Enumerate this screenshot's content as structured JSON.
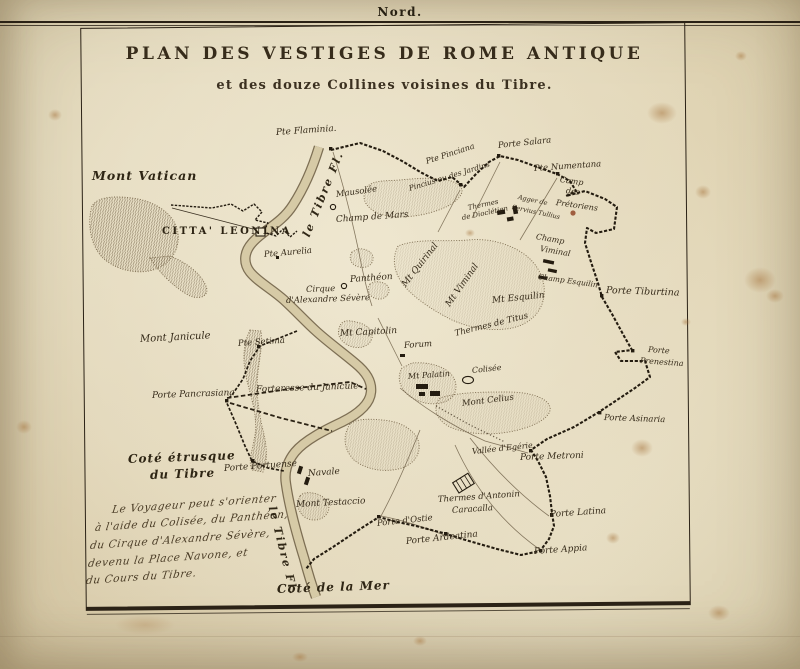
{
  "page": {
    "north_label": "Nord."
  },
  "map": {
    "title": "PLAN DES VESTIGES DE ROME ANTIQUE",
    "subtitle": "et des douze Collines voisines du Tibre.",
    "colors": {
      "ink": "#2b2214",
      "paper": "#e6ddc1",
      "river_fill": "#d6caa6",
      "river_edge": "#6a5a40",
      "stain": "#a97a45"
    },
    "labels": [
      {
        "t": "Pte Flaminia.",
        "x": 276,
        "y": 128,
        "r": -4,
        "s": 9
      },
      {
        "t": "Mont Vatican",
        "x": 92,
        "y": 168,
        "r": 0,
        "s": 12.5,
        "c": "bold"
      },
      {
        "t": "CITTA' LEONINA",
        "x": 162,
        "y": 226,
        "r": 0,
        "s": 10,
        "c": "caps"
      },
      {
        "t": "le Tibre Fl.",
        "x": 306,
        "y": 230,
        "r": -68,
        "s": 11,
        "c": "river"
      },
      {
        "t": "Mausolée",
        "x": 336,
        "y": 190,
        "r": -8,
        "s": 8.5
      },
      {
        "t": "Champ de Mars",
        "x": 336,
        "y": 215,
        "r": -4,
        "s": 9
      },
      {
        "t": "Pte Pinciana",
        "x": 426,
        "y": 157,
        "r": -18,
        "s": 8
      },
      {
        "t": "Pincius ou des Jardins",
        "x": 409,
        "y": 184,
        "r": -17,
        "s": 7.5
      },
      {
        "t": "Porte Salara",
        "x": 498,
        "y": 141,
        "r": -6,
        "s": 8.5
      },
      {
        "t": "Pte Numentana",
        "x": 534,
        "y": 164,
        "r": -4,
        "s": 8.5
      },
      {
        "t": "Camp",
        "x": 560,
        "y": 175,
        "r": 8,
        "s": 8
      },
      {
        "t": "des",
        "x": 566,
        "y": 186,
        "r": 8,
        "s": 8
      },
      {
        "t": "Prétoriens",
        "x": 556,
        "y": 198,
        "r": 8,
        "s": 8
      },
      {
        "t": "Agger de",
        "x": 518,
        "y": 193,
        "r": 12,
        "s": 6.5
      },
      {
        "t": "Servius Tullius",
        "x": 512,
        "y": 203,
        "r": 12,
        "s": 6.5
      },
      {
        "t": "Champ",
        "x": 536,
        "y": 232,
        "r": 10,
        "s": 8
      },
      {
        "t": "Viminal",
        "x": 540,
        "y": 244,
        "r": 10,
        "s": 8
      },
      {
        "t": "Champ Esquilin",
        "x": 538,
        "y": 272,
        "r": 8,
        "s": 7.5
      },
      {
        "t": "Porte Tiburtina",
        "x": 606,
        "y": 285,
        "r": 2,
        "s": 9.5
      },
      {
        "t": "Porte",
        "x": 648,
        "y": 345,
        "r": 4,
        "s": 8
      },
      {
        "t": "Prenestina",
        "x": 640,
        "y": 356,
        "r": 4,
        "s": 8
      },
      {
        "t": "Porte Asinaria",
        "x": 604,
        "y": 413,
        "r": 2,
        "s": 8.5
      },
      {
        "t": "Thermes",
        "x": 468,
        "y": 204,
        "r": -12,
        "s": 7
      },
      {
        "t": "de Dioclétien",
        "x": 462,
        "y": 214,
        "r": -12,
        "s": 7
      },
      {
        "t": "Mt Quirinal",
        "x": 404,
        "y": 281,
        "r": -52,
        "s": 9
      },
      {
        "t": "Mt Viminal",
        "x": 448,
        "y": 301,
        "r": -55,
        "s": 9
      },
      {
        "t": "Mt Esquilin",
        "x": 492,
        "y": 296,
        "r": -6,
        "s": 9
      },
      {
        "t": "Thermes de Titus",
        "x": 455,
        "y": 329,
        "r": -14,
        "s": 8.5
      },
      {
        "t": "Colisée",
        "x": 472,
        "y": 366,
        "r": -6,
        "s": 8
      },
      {
        "t": "Forum",
        "x": 404,
        "y": 341,
        "r": -4,
        "s": 8.5
      },
      {
        "t": "Mt Capitolin",
        "x": 340,
        "y": 329,
        "r": -3,
        "s": 9
      },
      {
        "t": "Panthéon",
        "x": 350,
        "y": 275,
        "r": -4,
        "s": 9
      },
      {
        "t": "Pte Aurelia",
        "x": 264,
        "y": 250,
        "r": -5,
        "s": 8.5
      },
      {
        "t": "Cirque",
        "x": 306,
        "y": 285,
        "r": -2,
        "s": 8.5
      },
      {
        "t": "d'Alexandre Sévère",
        "x": 286,
        "y": 296,
        "r": -2,
        "s": 8.5
      },
      {
        "t": "Mt Palatin",
        "x": 408,
        "y": 372,
        "r": -4,
        "s": 8
      },
      {
        "t": "Mont Celius",
        "x": 462,
        "y": 399,
        "r": -7,
        "s": 8.5
      },
      {
        "t": "Vallée d'Egérie",
        "x": 472,
        "y": 447,
        "r": -6,
        "s": 8
      },
      {
        "t": "Porte Metroni",
        "x": 520,
        "y": 453,
        "r": -2,
        "s": 9
      },
      {
        "t": "Porte Latina",
        "x": 550,
        "y": 510,
        "r": -4,
        "s": 9
      },
      {
        "t": "Porte Appia",
        "x": 534,
        "y": 547,
        "r": -4,
        "s": 9
      },
      {
        "t": "Thermes d'Antonin",
        "x": 438,
        "y": 495,
        "r": -4,
        "s": 8.5
      },
      {
        "t": "Caracalla",
        "x": 452,
        "y": 506,
        "r": -4,
        "s": 8.5
      },
      {
        "t": "Porte Ardeatina",
        "x": 406,
        "y": 537,
        "r": -6,
        "s": 9
      },
      {
        "t": "Porte d'Ostie",
        "x": 377,
        "y": 519,
        "r": -6,
        "s": 8.5
      },
      {
        "t": "Mont Testaccio",
        "x": 296,
        "y": 500,
        "r": -3,
        "s": 9
      },
      {
        "t": "Navale",
        "x": 308,
        "y": 469,
        "r": -4,
        "s": 9
      },
      {
        "t": "Porte Portuense",
        "x": 224,
        "y": 464,
        "r": -4,
        "s": 9
      },
      {
        "t": "Mont Janicule",
        "x": 140,
        "y": 334,
        "r": -3,
        "s": 10
      },
      {
        "t": "Pte Setima",
        "x": 238,
        "y": 339,
        "r": -4,
        "s": 8.5
      },
      {
        "t": "Porte Pancrasiana",
        "x": 152,
        "y": 391,
        "r": -2,
        "s": 9
      },
      {
        "t": "Forteresse du Janicule",
        "x": 256,
        "y": 385,
        "r": -2,
        "s": 9
      },
      {
        "t": "Coté étrusque",
        "x": 128,
        "y": 452,
        "r": -2,
        "s": 12,
        "c": "bold"
      },
      {
        "t": "du Tibre",
        "x": 150,
        "y": 468,
        "r": -2,
        "s": 12,
        "c": "bold"
      },
      {
        "t": "Le Voyageur peut s'orienter",
        "x": 112,
        "y": 504,
        "r": -4,
        "s": 10.5,
        "c": "script"
      },
      {
        "t": "à l'aide du Colisée, du Panthéon,",
        "x": 95,
        "y": 522,
        "r": -4,
        "s": 10.5,
        "c": "script"
      },
      {
        "t": "du Cirque d'Alexandre Sévère,",
        "x": 90,
        "y": 540,
        "r": -4,
        "s": 10.5,
        "c": "script"
      },
      {
        "t": "devenu la Place Navone, et",
        "x": 88,
        "y": 558,
        "r": -4,
        "s": 10.5,
        "c": "script"
      },
      {
        "t": "du Cours du Tibre.",
        "x": 86,
        "y": 575,
        "r": -4,
        "s": 10.5,
        "c": "script"
      },
      {
        "t": "le Tibre Fl.",
        "x": 272,
        "y": 500,
        "r": 76,
        "s": 11,
        "c": "river"
      },
      {
        "t": "Coté de la Mer",
        "x": 277,
        "y": 582,
        "r": -2,
        "s": 12,
        "c": "bold"
      }
    ]
  }
}
